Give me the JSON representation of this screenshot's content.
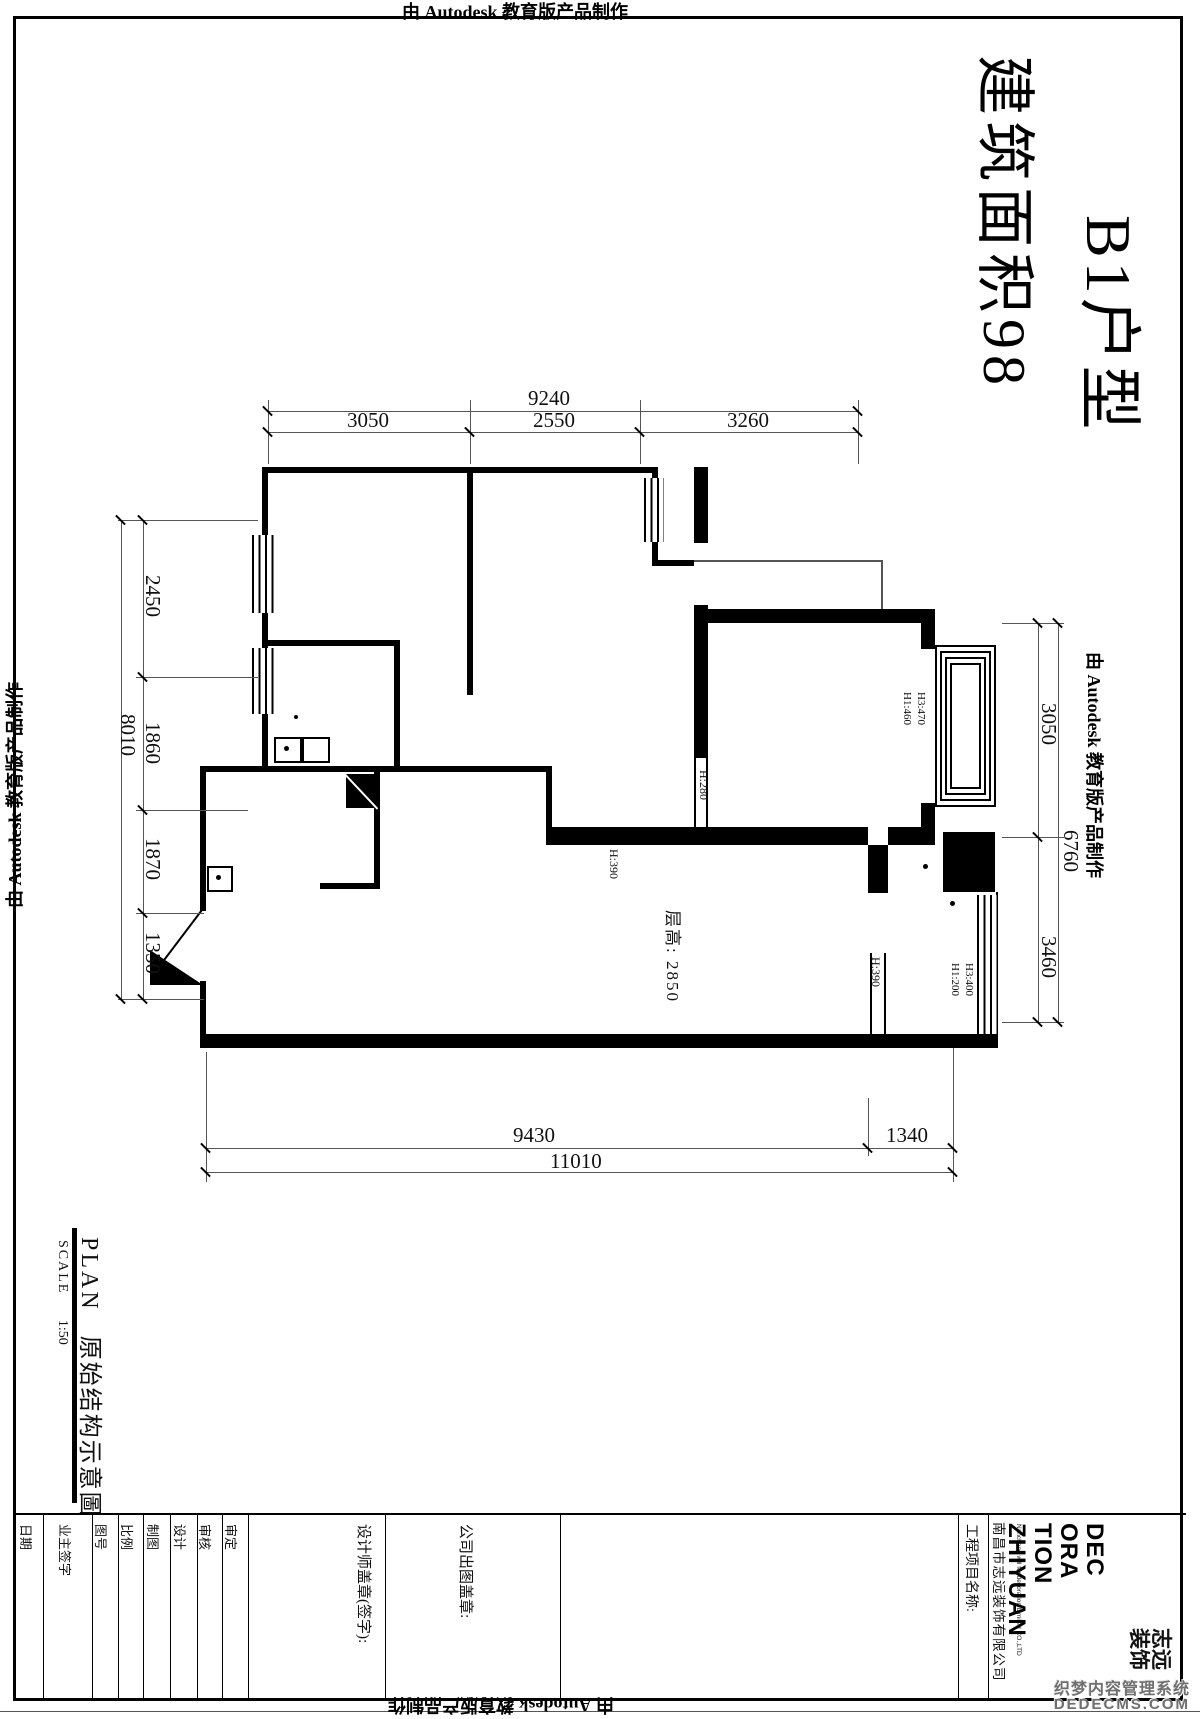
{
  "edges": {
    "autodesk_mark": "由 Autodesk 教育版产品制作"
  },
  "title": {
    "line1": "B1户型",
    "line2": "建筑面积98"
  },
  "dimensions": {
    "top": {
      "overall": "9240",
      "seg1": "3050",
      "seg2": "2550",
      "seg3": "3260"
    },
    "left": {
      "overall": "8010",
      "seg1": "2450",
      "seg2": "1860",
      "seg3": "1870",
      "seg4": "1350"
    },
    "right": {
      "overall": "6760",
      "seg1": "3050",
      "seg2": "3460"
    },
    "bottom": {
      "overall": "11010",
      "seg1": "9430",
      "seg2": "1340"
    }
  },
  "plan": {
    "ceiling_height": "层高: 2850",
    "h390_living": "H:390",
    "h390_balcony": "H:390",
    "h280": "H:280",
    "window_right_h1": "H1:460",
    "window_right_h3": "H3:470",
    "window_balcony_h1": "H1:200",
    "window_balcony_h3": "H3:400"
  },
  "plan_caption": {
    "en": "PLAN",
    "zh": "原始结构示意圖",
    "scale_label": "SCALE",
    "scale_value": "1:50"
  },
  "titleblock": {
    "fields": [
      "日期",
      "业主签字",
      "图号",
      "比例",
      "制图",
      "设计",
      "审核",
      "审定"
    ],
    "designer_seal": "设计师盖章(签字):",
    "company_seal": "公司出图盖章:",
    "project_name_label": "工程项目名称:",
    "company_name": "南昌市志远装饰有限公司",
    "company_name_en": "Nanchang will for decoration Limited CO.,LTD",
    "logo": {
      "l1": "DEC",
      "l2": "ORA",
      "l3": "TION",
      "l4": "ZHIYUAN",
      "zh1": "志远",
      "zh2": "装饰"
    }
  },
  "watermark": {
    "line1": "织梦内容管理系统",
    "line2": "DEDECMS.COM"
  }
}
